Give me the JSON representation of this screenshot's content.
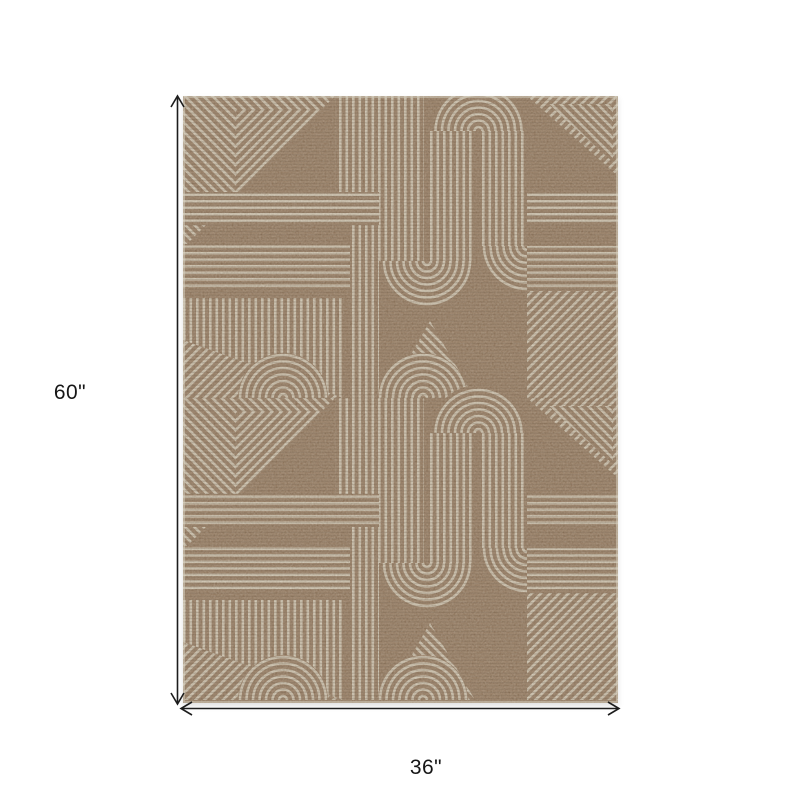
{
  "dimensions": {
    "height": {
      "label": "60\""
    },
    "width": {
      "label": "36\""
    }
  },
  "rug": {
    "label": "brown and ivory geometric maze area rug",
    "colors": {
      "base_brown": "#8a6c51",
      "stripe_cream": "#d9d2c0",
      "weave_dark": "#46311f",
      "dimension_line": "#1c1c1c",
      "page_background": "#ffffff"
    }
  }
}
